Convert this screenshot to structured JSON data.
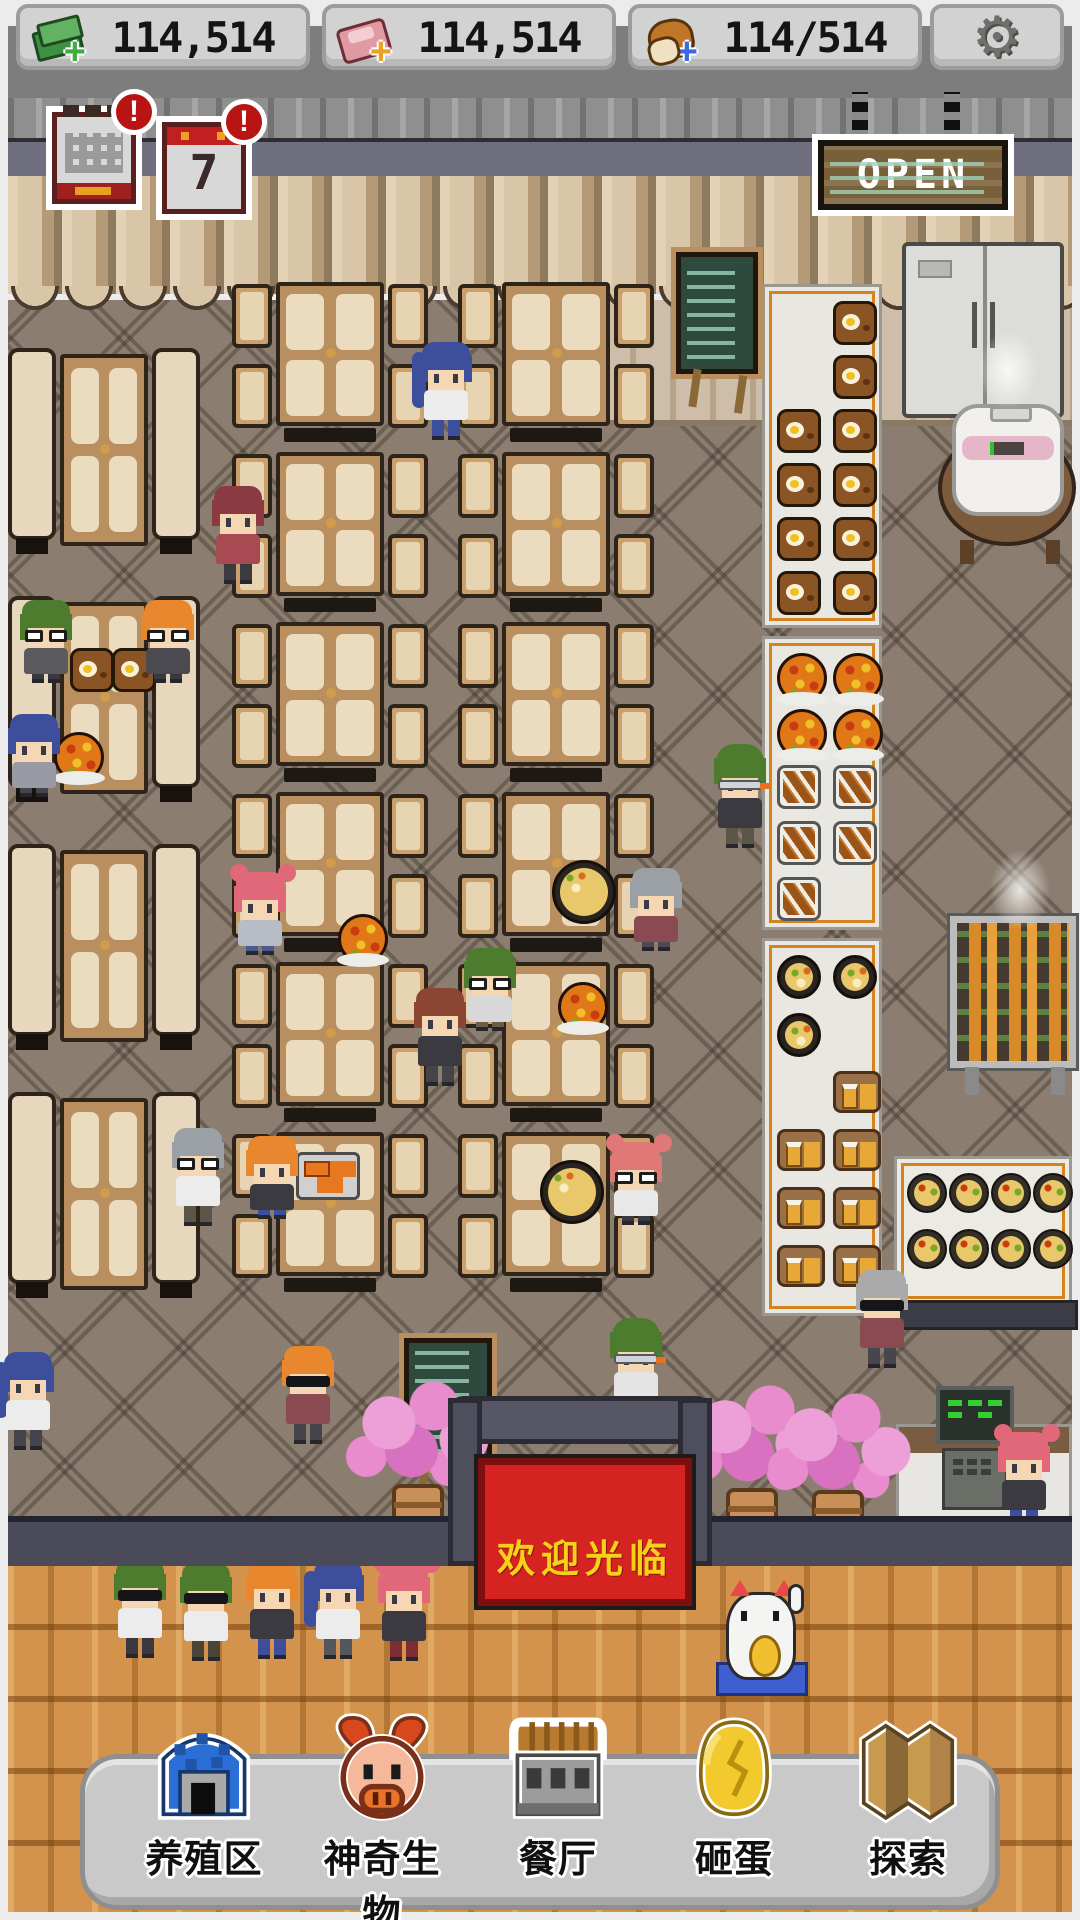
{
  "topbar": {
    "resources": [
      {
        "id": "cash",
        "icon": "cash-icon",
        "value": "114,514",
        "plus_color": "#3fae3f"
      },
      {
        "id": "meat",
        "icon": "meat-icon",
        "value": "114,514",
        "plus_color": "#f0a020"
      },
      {
        "id": "bread",
        "icon": "bread-icon",
        "value": "114/514",
        "plus_color": "#3a6ae0"
      }
    ],
    "settings_icon": "gear-icon"
  },
  "notifications": {
    "monthly_calendar": {
      "badge": "!"
    },
    "daily_calendar": {
      "badge": "!",
      "day": "7"
    }
  },
  "open_sign": {
    "label": "OPEN"
  },
  "entrance": {
    "welcome_banner": "欢迎光临"
  },
  "toolbar": {
    "buttons": [
      {
        "id": "ranch",
        "label": "养殖区",
        "icon": "barn-icon"
      },
      {
        "id": "creatures",
        "label": "神奇生物",
        "icon": "pig-icon"
      },
      {
        "id": "restaurant",
        "label": "餐厅",
        "icon": "restaurant-icon"
      },
      {
        "id": "smash-egg",
        "label": "砸蛋",
        "icon": "golden-egg-icon"
      },
      {
        "id": "explore",
        "label": "探索",
        "icon": "map-icon"
      }
    ]
  },
  "palette": {
    "topbar_bg": "#7d7d7d",
    "button_bg": "#d2d2d2",
    "badge_red": "#b81414",
    "banner_red": "#d42320",
    "banner_text": "#f6d11a",
    "sign_wood": "#7a6038",
    "floor": "#8b7e70",
    "wood_floor": "#d3934c",
    "front_wall": "#4a4a58",
    "rack_accent": "#d5831f",
    "toolbar_bg": "#c9c9c9"
  },
  "scene": {
    "booths": [
      {
        "x": 8,
        "y": 348
      },
      {
        "x": 8,
        "y": 596
      },
      {
        "x": 8,
        "y": 844
      },
      {
        "x": 8,
        "y": 1092
      }
    ],
    "tables": [
      {
        "x": 232,
        "y": 282
      },
      {
        "x": 232,
        "y": 452
      },
      {
        "x": 232,
        "y": 622
      },
      {
        "x": 232,
        "y": 792
      },
      {
        "x": 232,
        "y": 962
      },
      {
        "x": 232,
        "y": 1132
      },
      {
        "x": 458,
        "y": 282
      },
      {
        "x": 458,
        "y": 452
      },
      {
        "x": 458,
        "y": 622
      },
      {
        "x": 458,
        "y": 792
      },
      {
        "x": 458,
        "y": 962
      },
      {
        "x": 458,
        "y": 1132
      }
    ],
    "racks": [
      {
        "id": "curry",
        "x": 762,
        "y": 284,
        "h": 344,
        "cell": 54,
        "items": [
          {
            "t": "curry",
            "c": 1,
            "r": 0
          },
          {
            "t": "curry",
            "c": 1,
            "r": 1
          },
          {
            "t": "curry",
            "c": 0,
            "r": 2
          },
          {
            "t": "curry",
            "c": 1,
            "r": 2
          },
          {
            "t": "curry",
            "c": 0,
            "r": 3
          },
          {
            "t": "curry",
            "c": 1,
            "r": 3
          },
          {
            "t": "curry",
            "c": 0,
            "r": 4
          },
          {
            "t": "curry",
            "c": 1,
            "r": 4
          },
          {
            "t": "curry",
            "c": 0,
            "r": 5
          },
          {
            "t": "curry",
            "c": 1,
            "r": 5
          }
        ]
      },
      {
        "id": "pizza-skewer",
        "x": 762,
        "y": 636,
        "h": 294,
        "cell": 56,
        "items": [
          {
            "t": "pizza",
            "c": 0,
            "r": 0
          },
          {
            "t": "pizza",
            "c": 1,
            "r": 0
          },
          {
            "t": "pizza",
            "c": 0,
            "r": 1
          },
          {
            "t": "pizza",
            "c": 1,
            "r": 1
          },
          {
            "t": "skewer",
            "c": 0,
            "r": 2
          },
          {
            "t": "skewer",
            "c": 1,
            "r": 2
          },
          {
            "t": "skewer",
            "c": 0,
            "r": 3
          },
          {
            "t": "skewer",
            "c": 1,
            "r": 3
          },
          {
            "t": "skewer",
            "c": 0,
            "r": 4
          }
        ]
      },
      {
        "id": "rice-beer",
        "x": 762,
        "y": 938,
        "h": 378,
        "cell": 58,
        "items": [
          {
            "t": "rice",
            "c": 0,
            "r": 0
          },
          {
            "t": "rice",
            "c": 1,
            "r": 0
          },
          {
            "t": "rice",
            "c": 0,
            "r": 1
          },
          {
            "t": "beer",
            "c": 1,
            "r": 2
          },
          {
            "t": "beer",
            "c": 0,
            "r": 3
          },
          {
            "t": "beer",
            "c": 1,
            "r": 3
          },
          {
            "t": "beer",
            "c": 0,
            "r": 4
          },
          {
            "t": "beer",
            "c": 1,
            "r": 4
          },
          {
            "t": "beer",
            "c": 0,
            "r": 5
          },
          {
            "t": "beer",
            "c": 1,
            "r": 5
          }
        ]
      }
    ],
    "sushi": {
      "rows": 2,
      "cols": 4
    },
    "food": [
      {
        "t": "curry",
        "x": 70,
        "y": 648
      },
      {
        "t": "curry",
        "x": 112,
        "y": 648
      },
      {
        "t": "pizza",
        "x": 54,
        "y": 732
      },
      {
        "t": "pizza",
        "x": 338,
        "y": 914
      },
      {
        "t": "pizza",
        "x": 558,
        "y": 982
      },
      {
        "t": "rice-lg",
        "x": 552,
        "y": 860
      },
      {
        "t": "rice-lg",
        "x": 540,
        "y": 1160
      },
      {
        "t": "bento",
        "x": 296,
        "y": 1152
      }
    ],
    "characters": [
      {
        "role": "customer",
        "x": 418,
        "y": 342,
        "hair": "#3d4f9c",
        "style": "pony",
        "top": "#ececec",
        "bottom": "#3d4f9c",
        "pose": "stand",
        "eye": "none"
      },
      {
        "role": "customer",
        "x": 18,
        "y": 600,
        "hair": "#4e7c2e",
        "style": "short",
        "top": "#5a5a5f",
        "bottom": "#3a3a3e",
        "pose": "sit",
        "eye": "glasses"
      },
      {
        "role": "customer",
        "x": 140,
        "y": 600,
        "hair": "#e8872e",
        "style": "short",
        "top": "#4a4a50",
        "bottom": "#3a3a3e",
        "pose": "sit",
        "eye": "glasses"
      },
      {
        "role": "customer",
        "x": 210,
        "y": 486,
        "hair": "#8a3a40",
        "style": "short",
        "top": "#a84a52",
        "bottom": "#3c3c40",
        "pose": "stand",
        "eye": "none"
      },
      {
        "role": "customer",
        "x": 6,
        "y": 714,
        "hair": "#3d4f9c",
        "style": "short",
        "top": "#9a9aa4",
        "bottom": "#44444a",
        "pose": "sit",
        "eye": "none"
      },
      {
        "role": "customer",
        "x": 232,
        "y": 872,
        "hair": "#e06878",
        "style": "buns",
        "top": "#b8bcc4",
        "bottom": "#4a5a8c",
        "pose": "sit",
        "eye": "none"
      },
      {
        "role": "customer",
        "x": 412,
        "y": 988,
        "hair": "#8a4632",
        "style": "short",
        "top": "#3a3a40",
        "bottom": "#44444a",
        "pose": "stand",
        "eye": "none"
      },
      {
        "role": "customer",
        "x": 462,
        "y": 948,
        "hair": "#4e7c2e",
        "style": "short",
        "top": "#d8d8d8",
        "bottom": "#6a5c48",
        "pose": "sit",
        "eye": "glasses"
      },
      {
        "role": "customer",
        "x": 628,
        "y": 868,
        "hair": "#9aa0a6",
        "style": "short",
        "top": "#8a4a52",
        "bottom": "#4a4a50",
        "pose": "sit",
        "eye": "none"
      },
      {
        "role": "customer",
        "x": 244,
        "y": 1136,
        "hair": "#e8872e",
        "style": "short",
        "top": "#3a3a40",
        "bottom": "#3d4f9c",
        "pose": "sit",
        "eye": "none"
      },
      {
        "role": "customer",
        "x": 608,
        "y": 1142,
        "hair": "#e07878",
        "style": "buns",
        "top": "#e8e8e8",
        "bottom": "#3a3a44",
        "pose": "sit",
        "eye": "glasses"
      },
      {
        "role": "customer",
        "x": 170,
        "y": 1128,
        "hair": "#9aa0a6",
        "style": "short",
        "top": "#ececec",
        "bottom": "#5c5648",
        "pose": "stand",
        "eye": "glasses"
      },
      {
        "role": "customer",
        "x": 712,
        "y": 744,
        "hair": "#4e7c2e",
        "style": "cap",
        "top": "#3a3a40",
        "bottom": "#5c5648",
        "pose": "stand",
        "eye": "goggles"
      },
      {
        "role": "customer",
        "x": 608,
        "y": 1318,
        "hair": "#4e7c2e",
        "style": "cap",
        "top": "#e4e4e4",
        "bottom": "#3a3a40",
        "pose": "stand",
        "eye": "goggles"
      },
      {
        "role": "customer",
        "x": 854,
        "y": 1270,
        "hair": "#aaaaaa",
        "style": "short",
        "top": "#8a4a52",
        "bottom": "#46464c",
        "pose": "stand",
        "eye": "sunglasses"
      },
      {
        "role": "customer",
        "x": 280,
        "y": 1346,
        "hair": "#e8872e",
        "style": "short",
        "top": "#8a4a52",
        "bottom": "#44444a",
        "pose": "stand",
        "eye": "sunglasses"
      },
      {
        "role": "customer",
        "x": 0,
        "y": 1352,
        "hair": "#3d4f9c",
        "style": "pony",
        "top": "#ececec",
        "bottom": "#44444a",
        "pose": "stand",
        "eye": "none"
      },
      {
        "role": "staff",
        "x": 996,
        "y": 1432,
        "hair": "#e06878",
        "style": "buns",
        "top": "#3a3a40",
        "bottom": "#3d4f9c",
        "pose": "stand",
        "eye": "none"
      },
      {
        "role": "queue-customer",
        "x": 112,
        "y": 1560,
        "hair": "#4e7c2e",
        "style": "short",
        "top": "#ececec",
        "bottom": "#3a3a3e",
        "pose": "stand",
        "eye": "sunglasses"
      },
      {
        "role": "queue-customer",
        "x": 178,
        "y": 1563,
        "hair": "#4e7c2e",
        "style": "short",
        "top": "#ececec",
        "bottom": "#4a4436",
        "pose": "stand",
        "eye": "sunglasses"
      },
      {
        "role": "queue-customer",
        "x": 244,
        "y": 1561,
        "hair": "#e8872e",
        "style": "short",
        "top": "#3a3a40",
        "bottom": "#3d4f9c",
        "pose": "stand",
        "eye": "none"
      },
      {
        "role": "queue-customer",
        "x": 310,
        "y": 1561,
        "hair": "#3d4f9c",
        "style": "pony",
        "top": "#ececec",
        "bottom": "#55555d",
        "pose": "stand",
        "eye": "none"
      },
      {
        "role": "queue-customer",
        "x": 376,
        "y": 1563,
        "hair": "#e06878",
        "style": "buns",
        "top": "#3a3a40",
        "bottom": "#7c2e34",
        "pose": "stand",
        "eye": "none"
      }
    ]
  }
}
